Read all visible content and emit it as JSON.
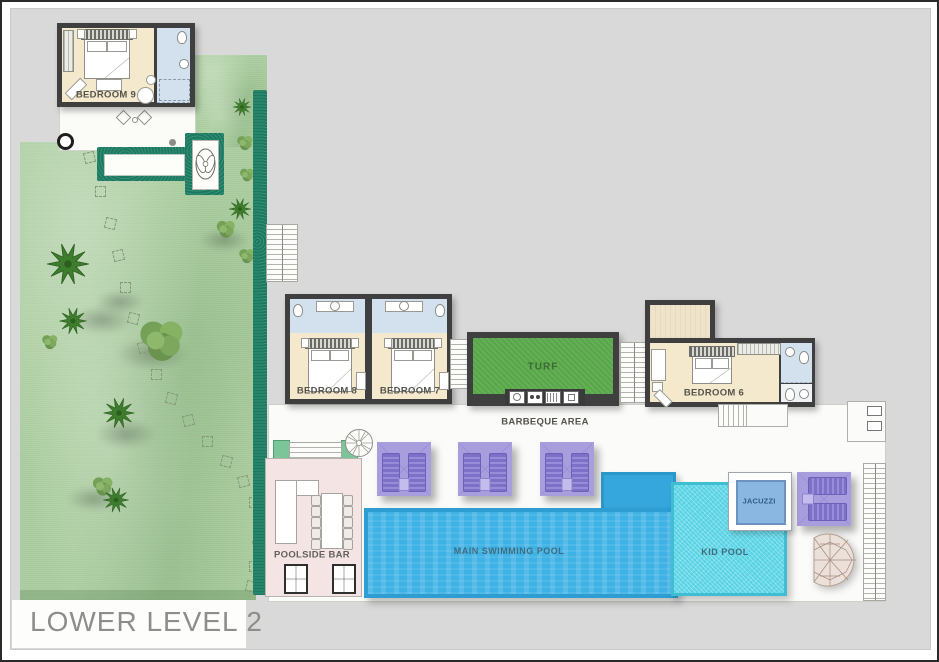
{
  "title": "LOWER LEVEL 2",
  "labels": {
    "bedroom9": "BEDROOM 9",
    "bedroom8": "BEDROOM 8",
    "bedroom7": "BEDROOM 7",
    "bedroom6": "BEDROOM 6",
    "turf": "TURF",
    "barbeque_area": "BARBEQUE AREA",
    "poolside_bar": "POOLSIDE BAR",
    "main_pool": "MAIN SWIMMING POOL",
    "kid_pool": "KID POOL",
    "jacuzzi": "JACUZZI"
  },
  "colors": {
    "background": "#d9d9d9",
    "garden": "#aecfa3",
    "hedge": "#1a7a5f",
    "turf": "#57a748",
    "wall": "#3f3f3f",
    "bedroom_floor": "#f4e8cd",
    "bathroom_floor": "#d3e1ee",
    "deck": "#fbfbf9",
    "main_pool": "#3fb2e5",
    "kid_pool": "#55d2e4",
    "jacuzzi": "#8ab7e2",
    "lounger": "#7d71c7",
    "lounger_mat": "#a89ddd",
    "bar_floor": "#f5e4e4",
    "title_text": "#8d8d8a",
    "label_text": "#55534b",
    "pool_label_text": "#3e6c80"
  }
}
